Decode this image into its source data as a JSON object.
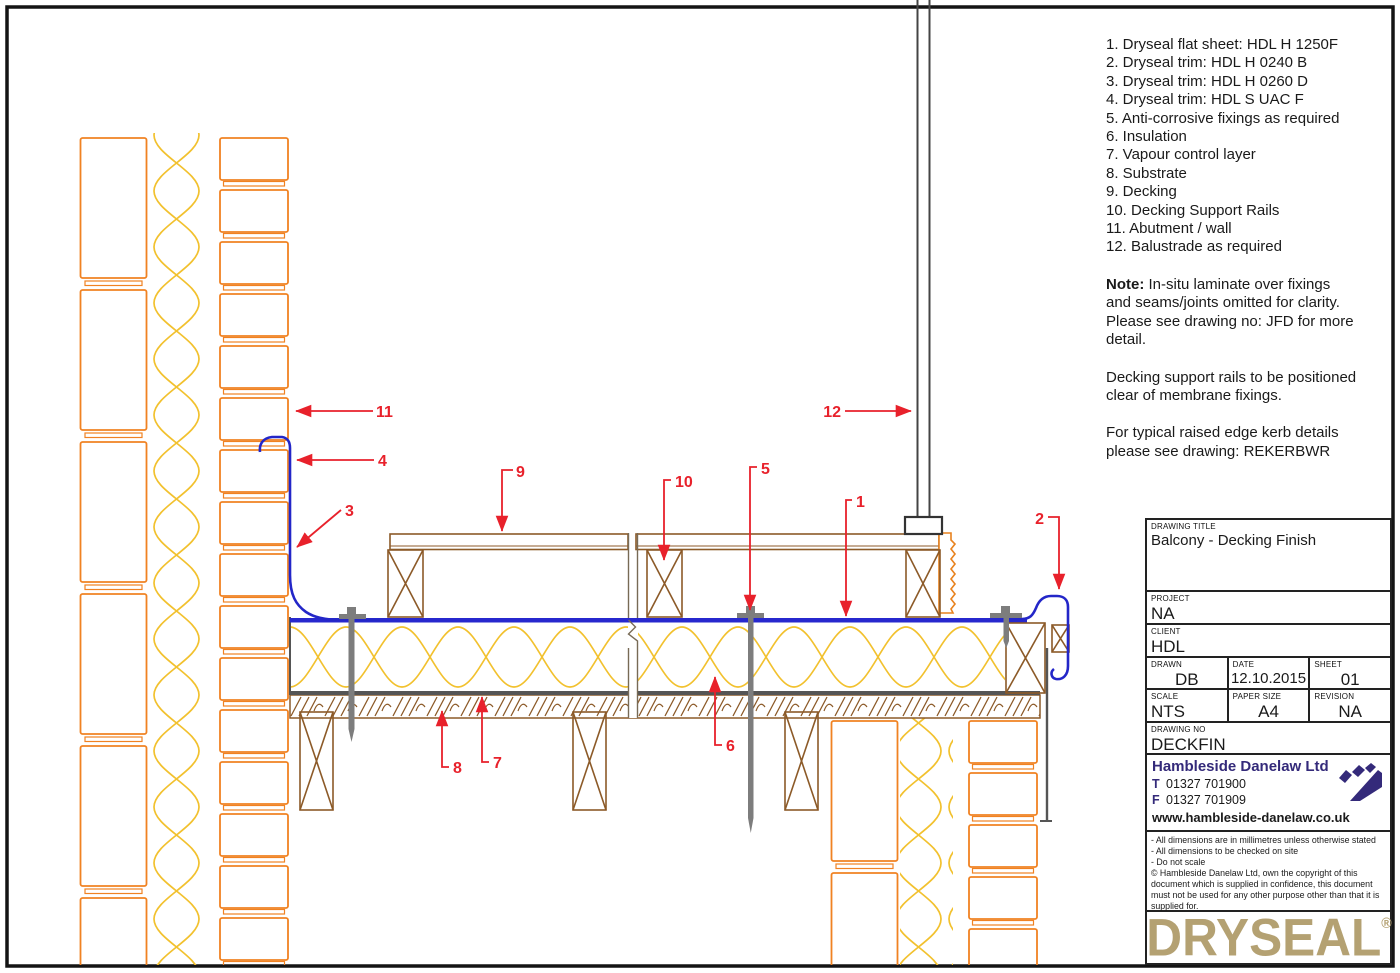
{
  "legend": {
    "items": [
      "1. Dryseal flat sheet: HDL H 1250F",
      "2. Dryseal trim: HDL H 0240 B",
      "3. Dryseal trim: HDL H 0260 D",
      "4. Dryseal trim: HDL S UAC F",
      "5. Anti-corrosive fixings as required",
      "6. Insulation",
      "7. Vapour control layer",
      "8. Substrate",
      "9. Decking",
      "10. Decking Support Rails",
      "11. Abutment / wall",
      "12. Balustrade as required"
    ],
    "note_label": "Note:",
    "note_body": " In-situ laminate over fixings and seams/joints omitted for clarity. Please see drawing no: JFD for more detail.",
    "para2": "Decking support rails to be positioned clear of membrane fixings.",
    "para3": "For typical raised edge kerb details please see drawing: REKERBWR"
  },
  "callouts": [
    "1",
    "2",
    "3",
    "4",
    "5",
    "6",
    "7",
    "8",
    "9",
    "10",
    "11",
    "12"
  ],
  "title_block": {
    "drawing_title_label": "DRAWING TITLE",
    "drawing_title": "Balcony - Decking Finish",
    "project_label": "PROJECT",
    "project": "NA",
    "client_label": "CLIENT",
    "client": "HDL",
    "drawn_label": "DRAWN",
    "drawn": "DB",
    "date_label": "DATE",
    "date": "12.10.2015",
    "sheet_label": "SHEET",
    "sheet": "01",
    "scale_label": "SCALE",
    "scale": "NTS",
    "paper_label": "PAPER SIZE",
    "paper": "A4",
    "revision_label": "REVISION",
    "revision": "NA",
    "drawing_no_label": "DRAWING NO",
    "drawing_no": "DECKFIN"
  },
  "company": {
    "name": "Hambleside Danelaw Ltd",
    "phone_label": "T",
    "phone": "01327 701900",
    "fax_label": "F",
    "fax": "01327 701909",
    "website": "www.hambleside-danelaw.co.uk"
  },
  "disclaimer": {
    "line1": "- All dimensions are in millimetres unless otherwise stated",
    "line2": "- All dimensions to be checked on site",
    "line3": "- Do not scale",
    "copyright_symbol": "©",
    "copyright": " Hambleside Danelaw Ltd, own the copyright of this document which is supplied in confidence, this document must not be used for any other purpose other than that it is supplied for."
  },
  "brand": {
    "logo": "DRYSEAL",
    "registered": "®"
  },
  "colors": {
    "masonry_orange": "#F08222",
    "insulation_gold": "#F2C12E",
    "timber_brown": "#8C5A28",
    "membrane_blue": "#2728CE",
    "callout_red": "#E8212B",
    "brand_tan": "#B4A172",
    "brand_purple": "#342A7A"
  }
}
